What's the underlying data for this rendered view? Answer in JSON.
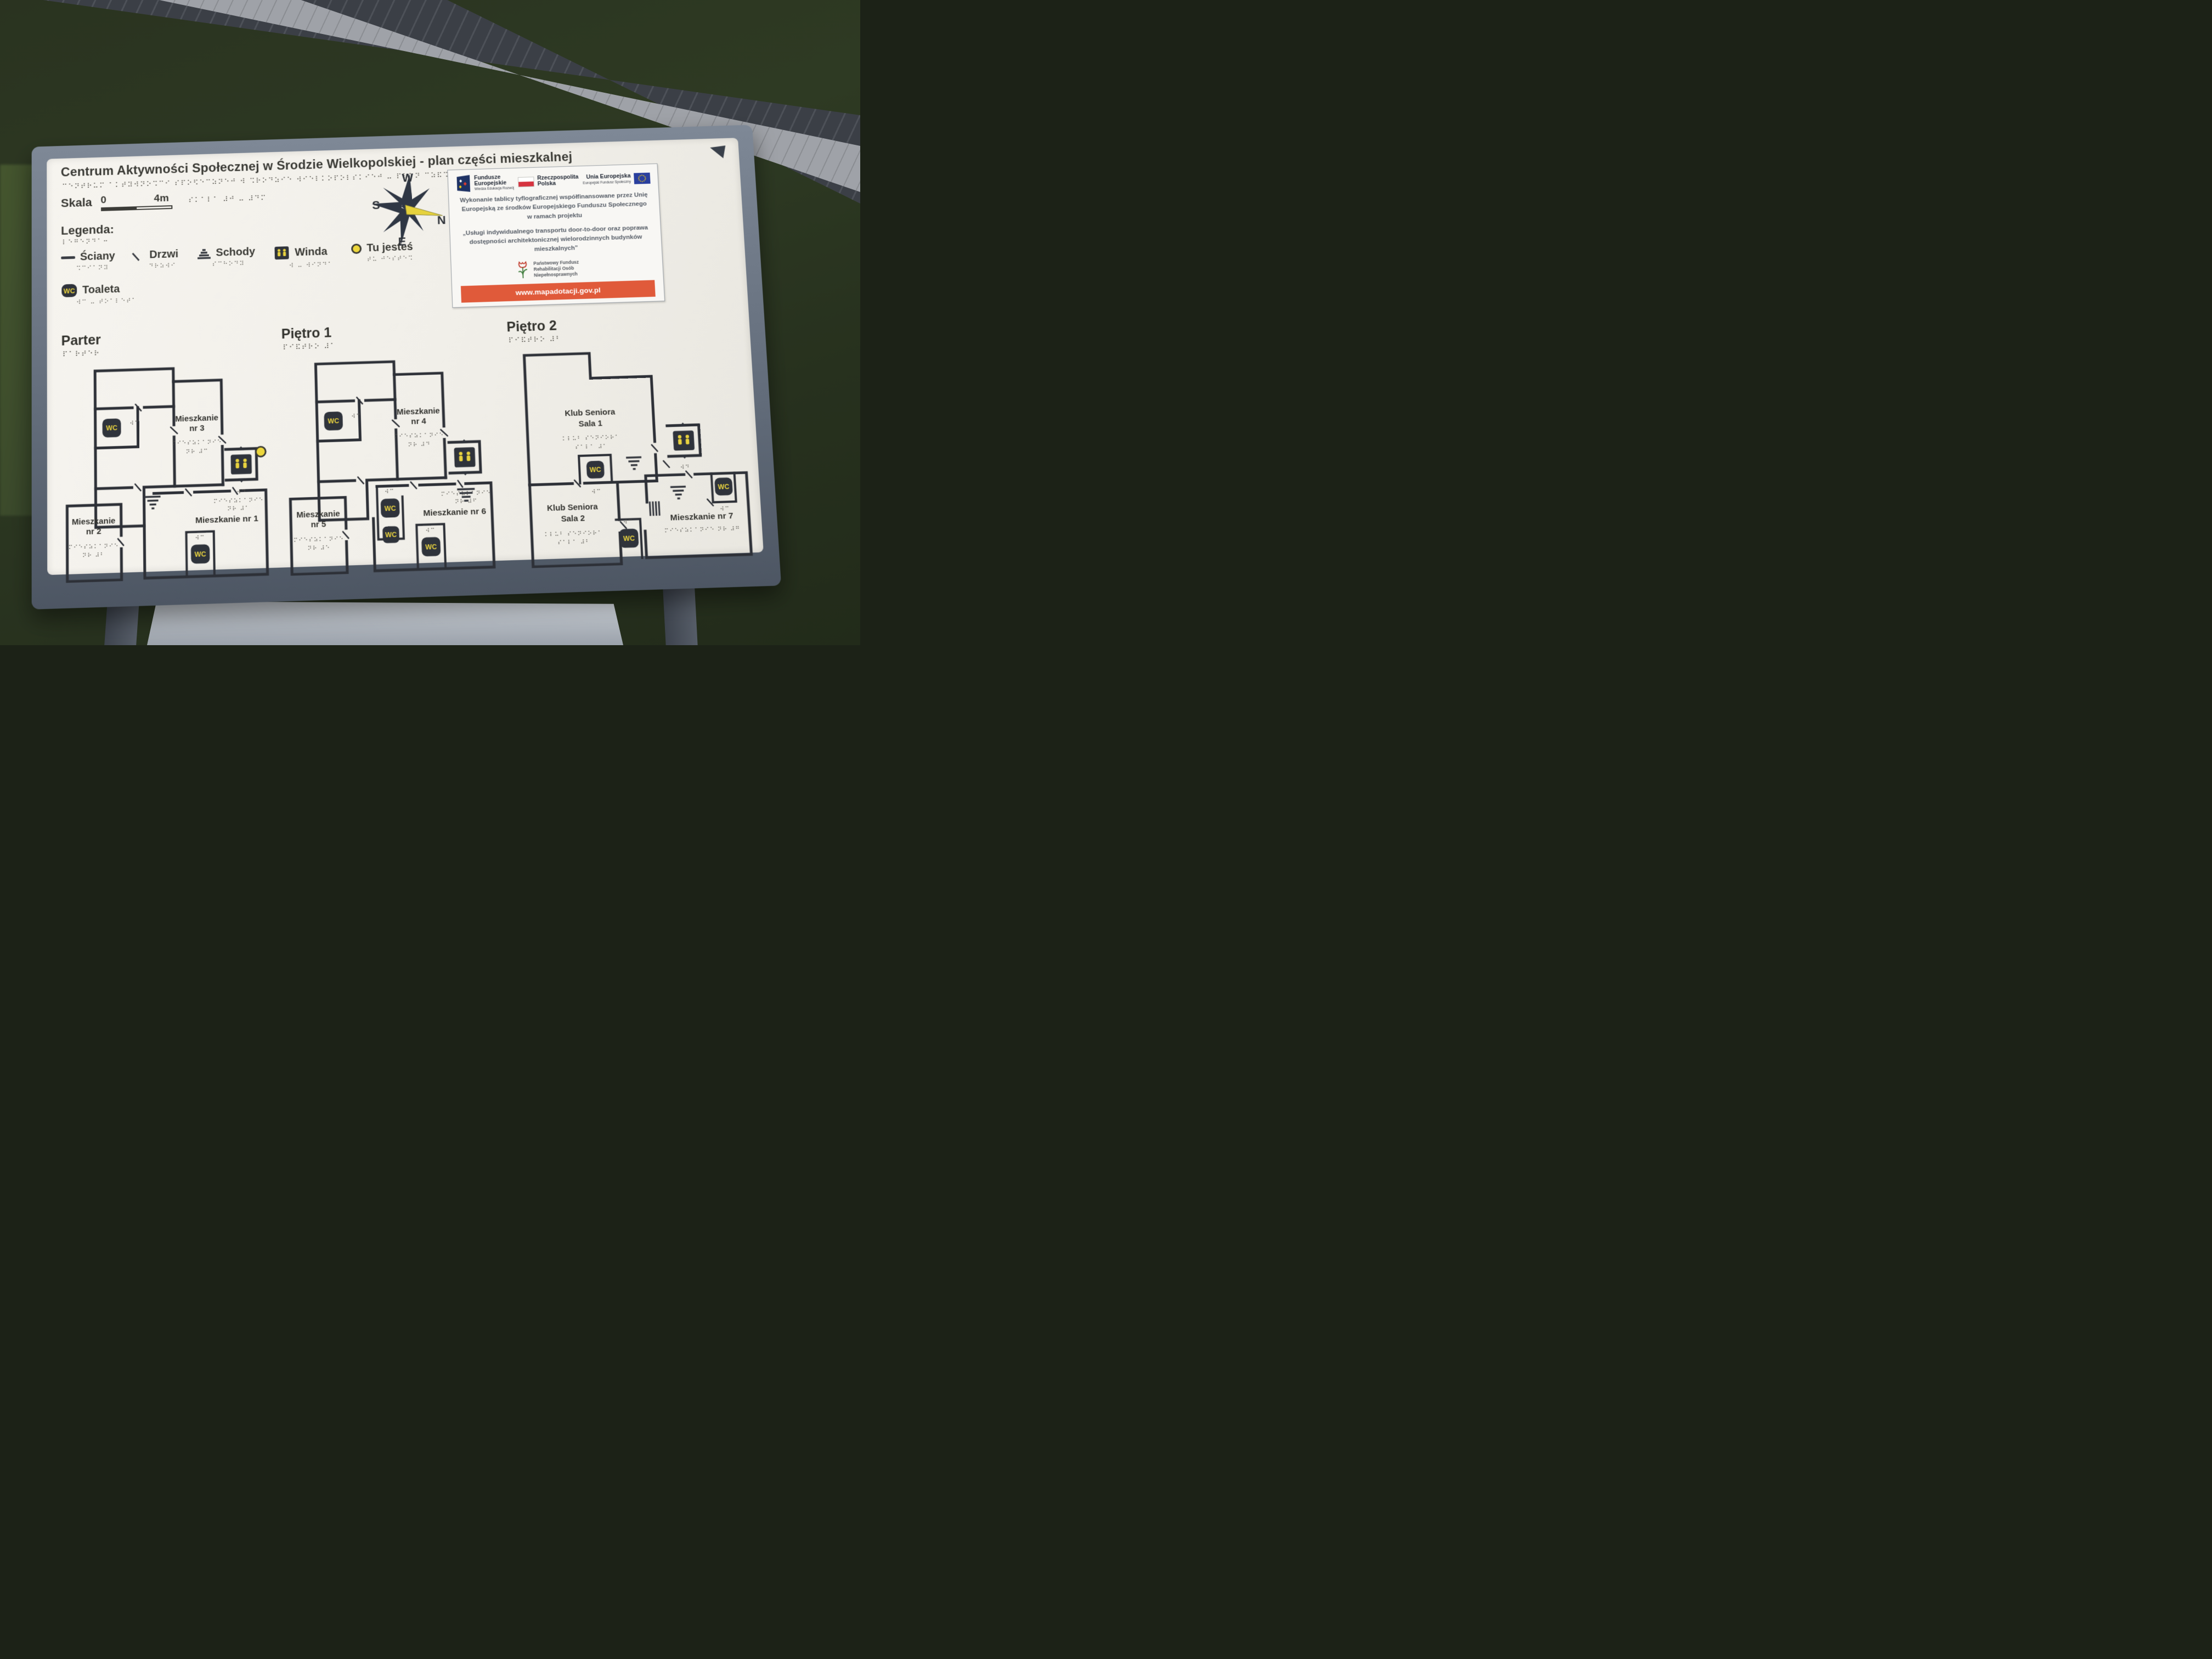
{
  "board": {
    "title": "Centrum Aktywności Społecznej w Środzie Wielkopolskiej - plan części mieszkalnej",
    "title_braille": "⠉⠑⠝⠞⠗⠥⠍ ⠁⠅⠞⠽⠺⠝⠕⠩⠉⠊ ⠎⠏⠕⠫⠑⠉⠵⠝⠑⠚ ⠺ ⠩⠗⠕⠙⠵⠊⠑ ⠺⠊⠑⠇⠅⠕⠏⠕⠇⠎⠅⠊⠑⠚ ⠤ ⠏⠇⠁⠝ ⠉⠵⠯⠩⠉⠊ ⠍⠊⠑⠎⠵⠅⠁⠇⠝⠑⠚",
    "scale": {
      "label": "Skala",
      "zero": "0",
      "four": "4m",
      "braille": "⠎⠅⠁⠇⠁ ⠼⠚ ⠤ ⠼⠙⠍"
    },
    "legend": {
      "heading": "Legenda:",
      "heading_braille": "⠇⠑⠛⠑⠝⠙⠁⠒",
      "items": [
        {
          "label": "Ściany",
          "braille": "⠩⠉⠊⠁⠝⠽"
        },
        {
          "label": "Drzwi",
          "braille": "⠙⠗⠵⠺⠊"
        },
        {
          "label": "Schody",
          "braille": "⠎⠉⠓⠕⠙⠽"
        },
        {
          "label": "Winda",
          "braille": "⠺ ⠤ ⠺⠊⠝⠙⠁"
        },
        {
          "label": "Tu jesteś",
          "braille": "⠞⠥ ⠚⠑⠎⠞⠑⠩"
        },
        {
          "label": "Toaleta",
          "braille": "⠺⠉ ⠤ ⠞⠕⠁⠇⠑⠞⠁"
        }
      ]
    },
    "compass": {
      "n": "N",
      "s": "S",
      "e": "E",
      "w": "W"
    }
  },
  "eu_box": {
    "fe_logo": {
      "line1": "Fundusze",
      "line2": "Europejskie",
      "sub": "Wiedza Edukacja Rozwój"
    },
    "pl_logo": {
      "line1": "Rzeczpospolita",
      "line2": "Polska"
    },
    "eu_logo": {
      "line1": "Unia Europejska",
      "sub": "Europejski Fundusz Społeczny"
    },
    "text1": "Wykonanie tablicy tyflograficznej współfinansowane przez Unię Europejską ze środków Europejskiego Funduszu Społecznego w ramach projektu",
    "text2": "„Usługi indywidualnego transportu door-to-door oraz poprawa dostępności architektonicznej wielorodzinnych budynków mieszkalnych”",
    "pfron": "Państwowy Fundusz Rehabilitacji Osób Niepełnosprawnych",
    "url": "www.mapadotacji.gov.pl"
  },
  "icons": {
    "wc_label": "WC",
    "wc_braille": "⠺⠉",
    "elevator_braille": "⠺⠙"
  },
  "floors": [
    {
      "name": "Parter",
      "braille": "⠏⠁⠗⠞⠑⠗",
      "rooms": {
        "m3_1": "Mieszkanie",
        "m3_2": "nr 3",
        "m3_br1": "⠍⠊⠑⠎⠵⠅⠁⠝⠊⠑",
        "m3_br2": "⠝⠗ ⠼⠉",
        "m2_1": "Mieszkanie",
        "m2_2": "nr 2",
        "m2_br1": "⠍⠊⠑⠎⠵⠅⠁⠝⠊⠑",
        "m2_br2": "⠝⠗ ⠼⠃",
        "m1": "Mieszkanie nr 1",
        "m1_br1": "⠍⠊⠑⠎⠵⠅⠁⠝⠊⠑",
        "m1_br2": "⠝⠗ ⠼⠁"
      }
    },
    {
      "name": "Piętro 1",
      "braille": "⠏⠊⠯⠞⠗⠕ ⠼⠁",
      "rooms": {
        "m4_1": "Mieszkanie",
        "m4_2": "nr 4",
        "m4_br1": "⠍⠊⠑⠎⠵⠅⠁⠝⠊⠑",
        "m4_br2": "⠝⠗ ⠼⠙",
        "m5_1": "Mieszkanie",
        "m5_2": "nr 5",
        "m5_br1": "⠍⠊⠑⠎⠵⠅⠁⠝⠊⠑",
        "m5_br2": "⠝⠗ ⠼⠑",
        "m6": "Mieszkanie nr 6",
        "m6_br1": "⠍⠊⠑⠎⠵⠅⠁⠝⠊⠑",
        "m6_br2": "⠝⠗ ⠼⠋"
      }
    },
    {
      "name": "Piętro 2",
      "braille": "⠏⠊⠯⠞⠗⠕ ⠼⠃",
      "rooms": {
        "ks1_1": "Klub Seniora",
        "ks1_2": "Sala 1",
        "ks1_br1": "⠅⠇⠥⠃ ⠎⠑⠝⠊⠕⠗⠁",
        "ks1_br2": "⠎⠁⠇⠁ ⠼⠁",
        "ks2_1": "Klub Seniora",
        "ks2_2": "Sala 2",
        "ks2_br1": "⠅⠇⠥⠃ ⠎⠑⠝⠊⠕⠗⠁",
        "ks2_br2": "⠎⠁⠇⠁ ⠼⠃",
        "m7": "Mieszkanie nr 7",
        "m7_br": "⠍⠊⠑⠎⠵⠅⠁⠝⠊⠑ ⠝⠗ ⠼⠛"
      }
    }
  ]
}
